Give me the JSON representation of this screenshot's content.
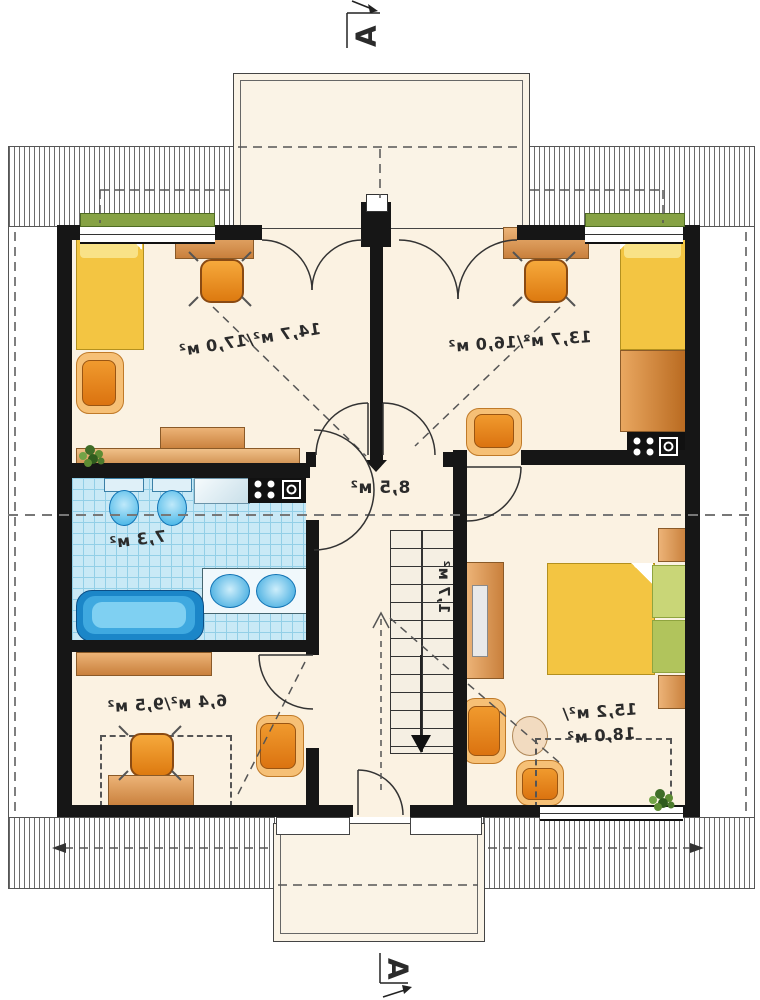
{
  "title": "Attic floor plan (mirror image)",
  "section_marks": {
    "top": "А",
    "bottom": "А"
  },
  "rooms": [
    {
      "name": "bedroom-top-left",
      "area": "14,7 м²/17,0 м²"
    },
    {
      "name": "bedroom-top-right",
      "area": "13,7 м²/16,0 м²"
    },
    {
      "name": "hall",
      "area": "8,5 м²"
    },
    {
      "name": "bathroom",
      "area": "7,3 м²"
    },
    {
      "name": "room-bottom-left",
      "area": "6,4 м²/9,5 м²"
    },
    {
      "name": "bedroom-bottom-right",
      "area_line1": "15,2 м²/",
      "area_line2": "18,0 м²"
    }
  ],
  "stairs": {
    "area": "1,7 м²",
    "direction": "down"
  },
  "colors": {
    "wall": "#161616",
    "room_floor": "#fbf2e2",
    "dormer_floor": "#faf3e6",
    "wood": "#cf8a44",
    "chair_orange": "#e8861e",
    "bed_yellow": "#f3c542",
    "cushion_green": "#b1c45c",
    "tile_blue": "#c9e9f6",
    "fixture_blue": "#35aee4",
    "plant_green": "#4c7a2d"
  },
  "furniture": {
    "bedroom_top_left": [
      "single-bed",
      "desk",
      "office-chair",
      "armchair",
      "dresser",
      "sideboard",
      "plant"
    ],
    "bedroom_top_right": [
      "single-bed",
      "desk",
      "office-chair",
      "armchair",
      "wardrobe",
      "media-cabinet"
    ],
    "bathroom": [
      "toilet",
      "bidet",
      "shower-tray",
      "washing-machine",
      "double-washbasin",
      "bathtub"
    ],
    "room_bottom_left": [
      "sideboard",
      "desk",
      "office-chair",
      "armchair"
    ],
    "bedroom_bottom_right": [
      "double-bed",
      "nightstand",
      "nightstand",
      "desk",
      "armchair",
      "side-table",
      "chair",
      "plant"
    ]
  }
}
